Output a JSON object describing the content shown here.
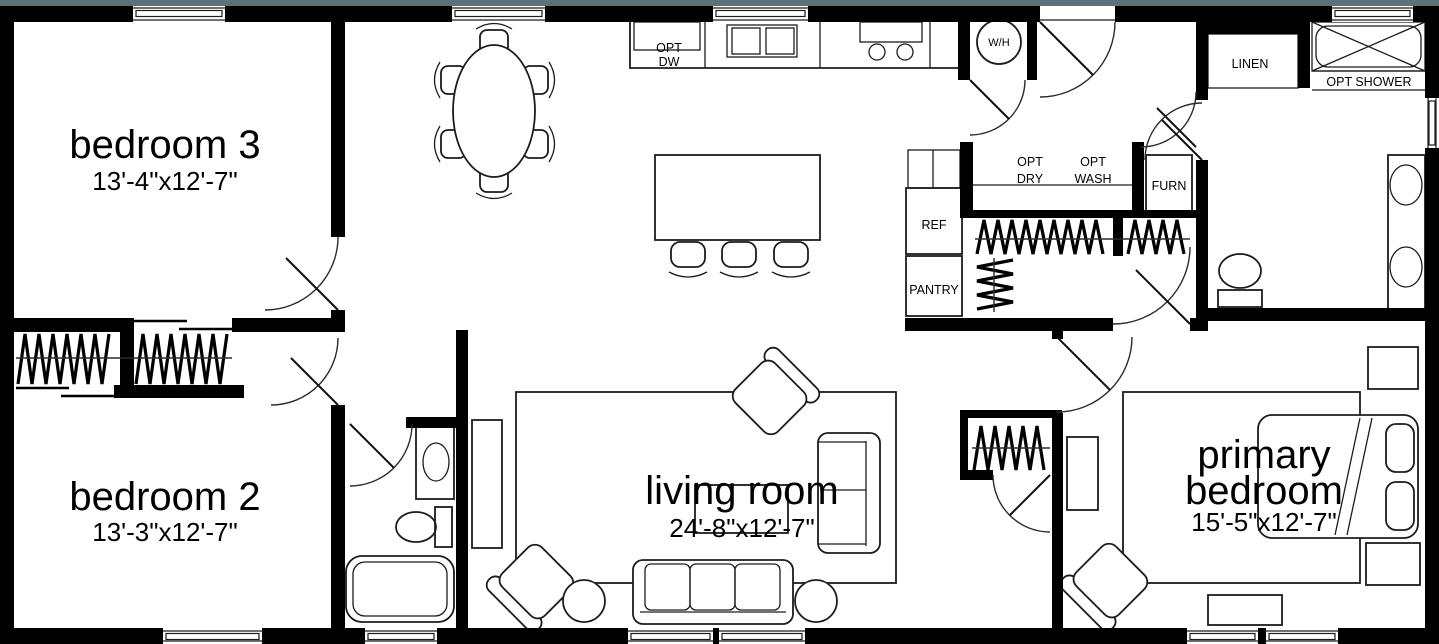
{
  "plan": {
    "type": "single-story floor plan",
    "colors": {
      "accent_top_band": "#5b7378",
      "walls": "#000000",
      "background": "#ffffff",
      "line": "#1c1c1c"
    },
    "rooms": {
      "bedroom3": {
        "name": "bedroom 3",
        "dims": "13'-4\"x12'-7\""
      },
      "bedroom2": {
        "name": "bedroom 2",
        "dims": "13'-3\"x12'-7\""
      },
      "living": {
        "name": "living room",
        "dims": "24'-8\"x12'-7\""
      },
      "primary": {
        "name_line1": "primary",
        "name_line2": "bedroom",
        "dims": "15'-5\"x12'-7\""
      }
    },
    "fixtures": {
      "dishwasher": {
        "line1": "OPT",
        "line2": "DW"
      },
      "water_heater": "W/H",
      "dryer": {
        "line1": "OPT",
        "line2": "DRY"
      },
      "washer": {
        "line1": "OPT",
        "line2": "WASH"
      },
      "furnace": "FURN",
      "refrigerator": "REF",
      "pantry": "PANTRY",
      "linen": "LINEN",
      "shower": "OPT SHOWER"
    }
  }
}
